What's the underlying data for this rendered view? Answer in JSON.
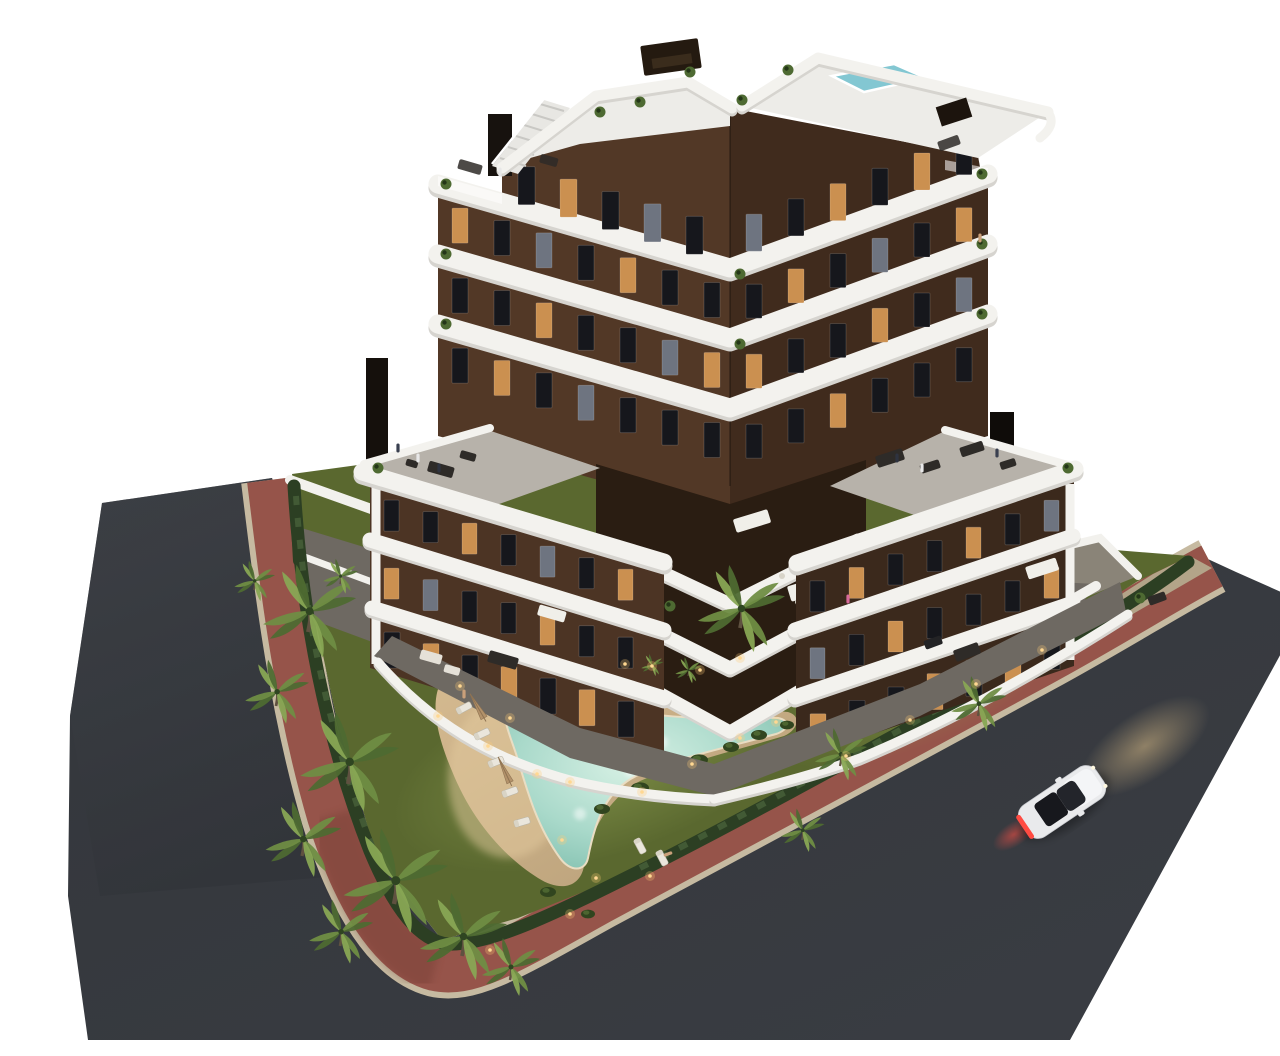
{
  "meta": {
    "description": "Aerial dusk 3D architectural rendering of a modern seven-storey apartment building with dark brown facades, curved white balcony bands, rooftop terraces with plunge pool, landscaped garden with free-form illuminated swimming pool, palm trees, terracotta sidewalks, asphalt roads and a white car driving past",
    "width": 1280,
    "height": 1024
  },
  "colors": {
    "bg": "#ffffff",
    "asphalt": "#3a3d42",
    "asphalt2": "#2e3136",
    "red": "#96544a",
    "red2": "#7e4439",
    "curb": "#c6baa1",
    "band": "#f3f2ee",
    "bandShade": "#d6d4cf",
    "facadeL": "#523826",
    "facadeR": "#402b1d",
    "wingL": "#4c3424",
    "wingR": "#3b291c",
    "recess": "#2a1d12",
    "deckGray": "#b7b2aa",
    "roofDeck": "#edece8",
    "terrace": "#6e6962",
    "terrace2": "#8a8478",
    "wall": "#f2f1ed",
    "winDark": "#16171c",
    "winLit": "#cb9050",
    "winDim": "#6e7480",
    "roofPool": "#83c7d2",
    "grass": "#5a682f",
    "grassLit": "#83944a",
    "hedge": "#2c3f23",
    "palm1": "#4e6a32",
    "palm2": "#6f8d43",
    "palm3": "#88a654",
    "trunk": "#5f5140",
    "sand": "#c9ae85",
    "sandLit": "#e3ca9e",
    "pool": "#a9d9ca",
    "poolDeep": "#7cbcab",
    "poolLight": "#d8f1e5",
    "tan": "#b3a489",
    "furnDark": "#2e2b28",
    "furnLight": "#e5e1d8",
    "carBody": "#e9eaec",
    "carGlass": "#17181d",
    "tail": "#ff4b42",
    "glowWarm": "#e6c68c",
    "lightDot": "#ffd892"
  },
  "building": {
    "storeys": 7,
    "window_rows": [
      {
        "x0": 478,
        "step": 42,
        "count": 5,
        "refX": 462,
        "slope": 0.295,
        "yBase": 146,
        "w": 17,
        "h": 38,
        "lit": [
          1
        ],
        "dim": [
          3
        ]
      },
      {
        "x0": 412,
        "step": 42,
        "count": 7,
        "refX": 398,
        "slope": 0.295,
        "yBase": 188,
        "w": 16,
        "h": 35,
        "lit": [
          0,
          4
        ],
        "dim": [
          2
        ]
      },
      {
        "x0": 412,
        "step": 42,
        "count": 7,
        "refX": 398,
        "slope": 0.295,
        "yBase": 258,
        "w": 16,
        "h": 35,
        "lit": [
          2,
          6
        ],
        "dim": [
          5
        ]
      },
      {
        "x0": 412,
        "step": 42,
        "count": 7,
        "refX": 398,
        "slope": 0.295,
        "yBase": 328,
        "w": 16,
        "h": 35,
        "lit": [
          1
        ],
        "dim": [
          3
        ]
      },
      {
        "x0": 706,
        "step": 42,
        "count": 6,
        "refX": 690,
        "slope": -0.364,
        "yBase": 204,
        "w": 16,
        "h": 37,
        "lit": [
          2,
          4
        ],
        "dim": [
          0
        ]
      },
      {
        "x0": 706,
        "step": 42,
        "count": 6,
        "refX": 690,
        "slope": -0.364,
        "yBase": 274,
        "w": 16,
        "h": 34,
        "lit": [
          1,
          5
        ],
        "dim": [
          3
        ]
      },
      {
        "x0": 706,
        "step": 42,
        "count": 6,
        "refX": 690,
        "slope": -0.364,
        "yBase": 344,
        "w": 16,
        "h": 34,
        "lit": [
          0,
          3
        ],
        "dim": [
          5
        ]
      },
      {
        "x0": 706,
        "step": 42,
        "count": 6,
        "refX": 690,
        "slope": -0.364,
        "yBase": 414,
        "w": 16,
        "h": 34,
        "lit": [
          2
        ],
        "dim": []
      },
      {
        "x0": 344,
        "step": 39,
        "count": 7,
        "refX": 330,
        "slope": 0.295,
        "yBase": 480,
        "w": 15,
        "h": 31,
        "lit": [
          2,
          6
        ],
        "dim": [
          4
        ]
      },
      {
        "x0": 344,
        "step": 39,
        "count": 7,
        "refX": 330,
        "slope": 0.295,
        "yBase": 548,
        "w": 15,
        "h": 31,
        "lit": [
          0,
          4
        ],
        "dim": [
          1
        ]
      },
      {
        "x0": 344,
        "step": 39,
        "count": 7,
        "refX": 330,
        "slope": 0.295,
        "yBase": 612,
        "w": 16,
        "h": 36,
        "lit": [
          1,
          3,
          5
        ],
        "dim": []
      },
      {
        "x0": 770,
        "step": 39,
        "count": 7,
        "refX": 755,
        "slope": -0.344,
        "yBase": 570,
        "w": 15,
        "h": 31,
        "lit": [
          1,
          4
        ],
        "dim": [
          6
        ]
      },
      {
        "x0": 770,
        "step": 39,
        "count": 7,
        "refX": 755,
        "slope": -0.344,
        "yBase": 637,
        "w": 15,
        "h": 31,
        "lit": [
          2,
          6
        ],
        "dim": [
          0
        ]
      },
      {
        "x0": 770,
        "step": 39,
        "count": 7,
        "refX": 755,
        "slope": -0.344,
        "yBase": 703,
        "w": 16,
        "h": 36,
        "lit": [
          0,
          3,
          5
        ],
        "dim": []
      }
    ]
  },
  "garden": {
    "palms": [
      {
        "x": 268,
        "y": 616,
        "s": 1.6
      },
      {
        "x": 236,
        "y": 690,
        "s": 1.1
      },
      {
        "x": 308,
        "y": 768,
        "s": 1.7
      },
      {
        "x": 262,
        "y": 840,
        "s": 1.3
      },
      {
        "x": 354,
        "y": 888,
        "s": 1.8
      },
      {
        "x": 300,
        "y": 930,
        "s": 1.1
      },
      {
        "x": 422,
        "y": 940,
        "s": 1.5
      },
      {
        "x": 470,
        "y": 964,
        "s": 1.0
      },
      {
        "x": 214,
        "y": 574,
        "s": 0.7
      },
      {
        "x": 300,
        "y": 568,
        "s": 0.6
      },
      {
        "x": 700,
        "y": 612,
        "s": 1.5
      },
      {
        "x": 800,
        "y": 750,
        "s": 0.9
      },
      {
        "x": 762,
        "y": 824,
        "s": 0.75
      },
      {
        "x": 938,
        "y": 700,
        "s": 0.95
      },
      {
        "x": 648,
        "y": 660,
        "s": 0.45
      },
      {
        "x": 612,
        "y": 654,
        "s": 0.38
      }
    ],
    "bushes": [
      {
        "x": 600,
        "y": 772,
        "r": 9
      },
      {
        "x": 629,
        "y": 757,
        "r": 8
      },
      {
        "x": 659,
        "y": 744,
        "r": 9
      },
      {
        "x": 691,
        "y": 731,
        "r": 8
      },
      {
        "x": 719,
        "y": 719,
        "r": 8
      },
      {
        "x": 747,
        "y": 709,
        "r": 7
      },
      {
        "x": 562,
        "y": 793,
        "r": 8
      },
      {
        "x": 900,
        "y": 672,
        "r": 9
      },
      {
        "x": 1012,
        "y": 627,
        "r": 8
      },
      {
        "x": 1060,
        "y": 600,
        "r": 7
      },
      {
        "x": 508,
        "y": 876,
        "r": 8
      },
      {
        "x": 548,
        "y": 898,
        "r": 7
      }
    ],
    "loungers": [
      {
        "x": 424,
        "y": 692,
        "a": -28
      },
      {
        "x": 442,
        "y": 718,
        "a": -25
      },
      {
        "x": 456,
        "y": 746,
        "a": -22
      },
      {
        "x": 470,
        "y": 776,
        "a": -20
      },
      {
        "x": 482,
        "y": 806,
        "a": -16
      },
      {
        "x": 600,
        "y": 830,
        "a": 62
      },
      {
        "x": 622,
        "y": 842,
        "a": 62
      }
    ],
    "umbrellas": [
      {
        "x": 440,
        "y": 702,
        "a": -30
      },
      {
        "x": 466,
        "y": 766,
        "a": -25
      }
    ],
    "lights": [
      {
        "x": 470,
        "y": 702
      },
      {
        "x": 497,
        "y": 758
      },
      {
        "x": 522,
        "y": 824
      },
      {
        "x": 556,
        "y": 862
      },
      {
        "x": 602,
        "y": 776
      },
      {
        "x": 652,
        "y": 748
      },
      {
        "x": 700,
        "y": 722
      },
      {
        "x": 736,
        "y": 706
      },
      {
        "x": 612,
        "y": 650
      },
      {
        "x": 585,
        "y": 648
      },
      {
        "x": 660,
        "y": 654
      },
      {
        "x": 700,
        "y": 642
      },
      {
        "x": 420,
        "y": 670
      },
      {
        "x": 398,
        "y": 700
      },
      {
        "x": 448,
        "y": 730
      },
      {
        "x": 530,
        "y": 766
      },
      {
        "x": 806,
        "y": 740
      },
      {
        "x": 870,
        "y": 704
      },
      {
        "x": 936,
        "y": 668
      },
      {
        "x": 1002,
        "y": 634
      },
      {
        "x": 450,
        "y": 934
      },
      {
        "x": 530,
        "y": 898
      },
      {
        "x": 610,
        "y": 860
      }
    ],
    "band_plants": [
      {
        "x": 406,
        "y": 168
      },
      {
        "x": 406,
        "y": 238
      },
      {
        "x": 406,
        "y": 308
      },
      {
        "x": 700,
        "y": 258
      },
      {
        "x": 700,
        "y": 328
      },
      {
        "x": 942,
        "y": 158
      },
      {
        "x": 942,
        "y": 228
      },
      {
        "x": 942,
        "y": 298
      },
      {
        "x": 338,
        "y": 452
      },
      {
        "x": 1028,
        "y": 452
      },
      {
        "x": 560,
        "y": 96
      },
      {
        "x": 600,
        "y": 86
      },
      {
        "x": 650,
        "y": 56
      },
      {
        "x": 702,
        "y": 84
      },
      {
        "x": 748,
        "y": 54
      },
      {
        "x": 630,
        "y": 590
      },
      {
        "x": 1100,
        "y": 582
      }
    ]
  },
  "people": [
    {
      "x": 460,
      "y": 156,
      "c": "#e8e8e8",
      "a": 0
    },
    {
      "x": 358,
      "y": 432,
      "c": "#3a4050",
      "a": 0
    },
    {
      "x": 378,
      "y": 442,
      "c": "#e8e8e8",
      "a": 0
    },
    {
      "x": 399,
      "y": 452,
      "c": "#2e3340",
      "a": 0
    },
    {
      "x": 857,
      "y": 442,
      "c": "#2e3340",
      "a": 0
    },
    {
      "x": 882,
      "y": 452,
      "c": "#e8e8e8",
      "a": 0
    },
    {
      "x": 957,
      "y": 437,
      "c": "#3a4050",
      "a": 0
    },
    {
      "x": 424,
      "y": 678,
      "c": "#caa07a",
      "a": 0
    },
    {
      "x": 808,
      "y": 583,
      "c": "#d86a9a",
      "a": 0
    },
    {
      "x": 628,
      "y": 838,
      "c": "#caa07a",
      "a": 70
    },
    {
      "x": 940,
      "y": 222,
      "c": "#caa07a",
      "a": 0
    }
  ],
  "car": {
    "x": 1022,
    "y": 786,
    "angle": -34
  }
}
